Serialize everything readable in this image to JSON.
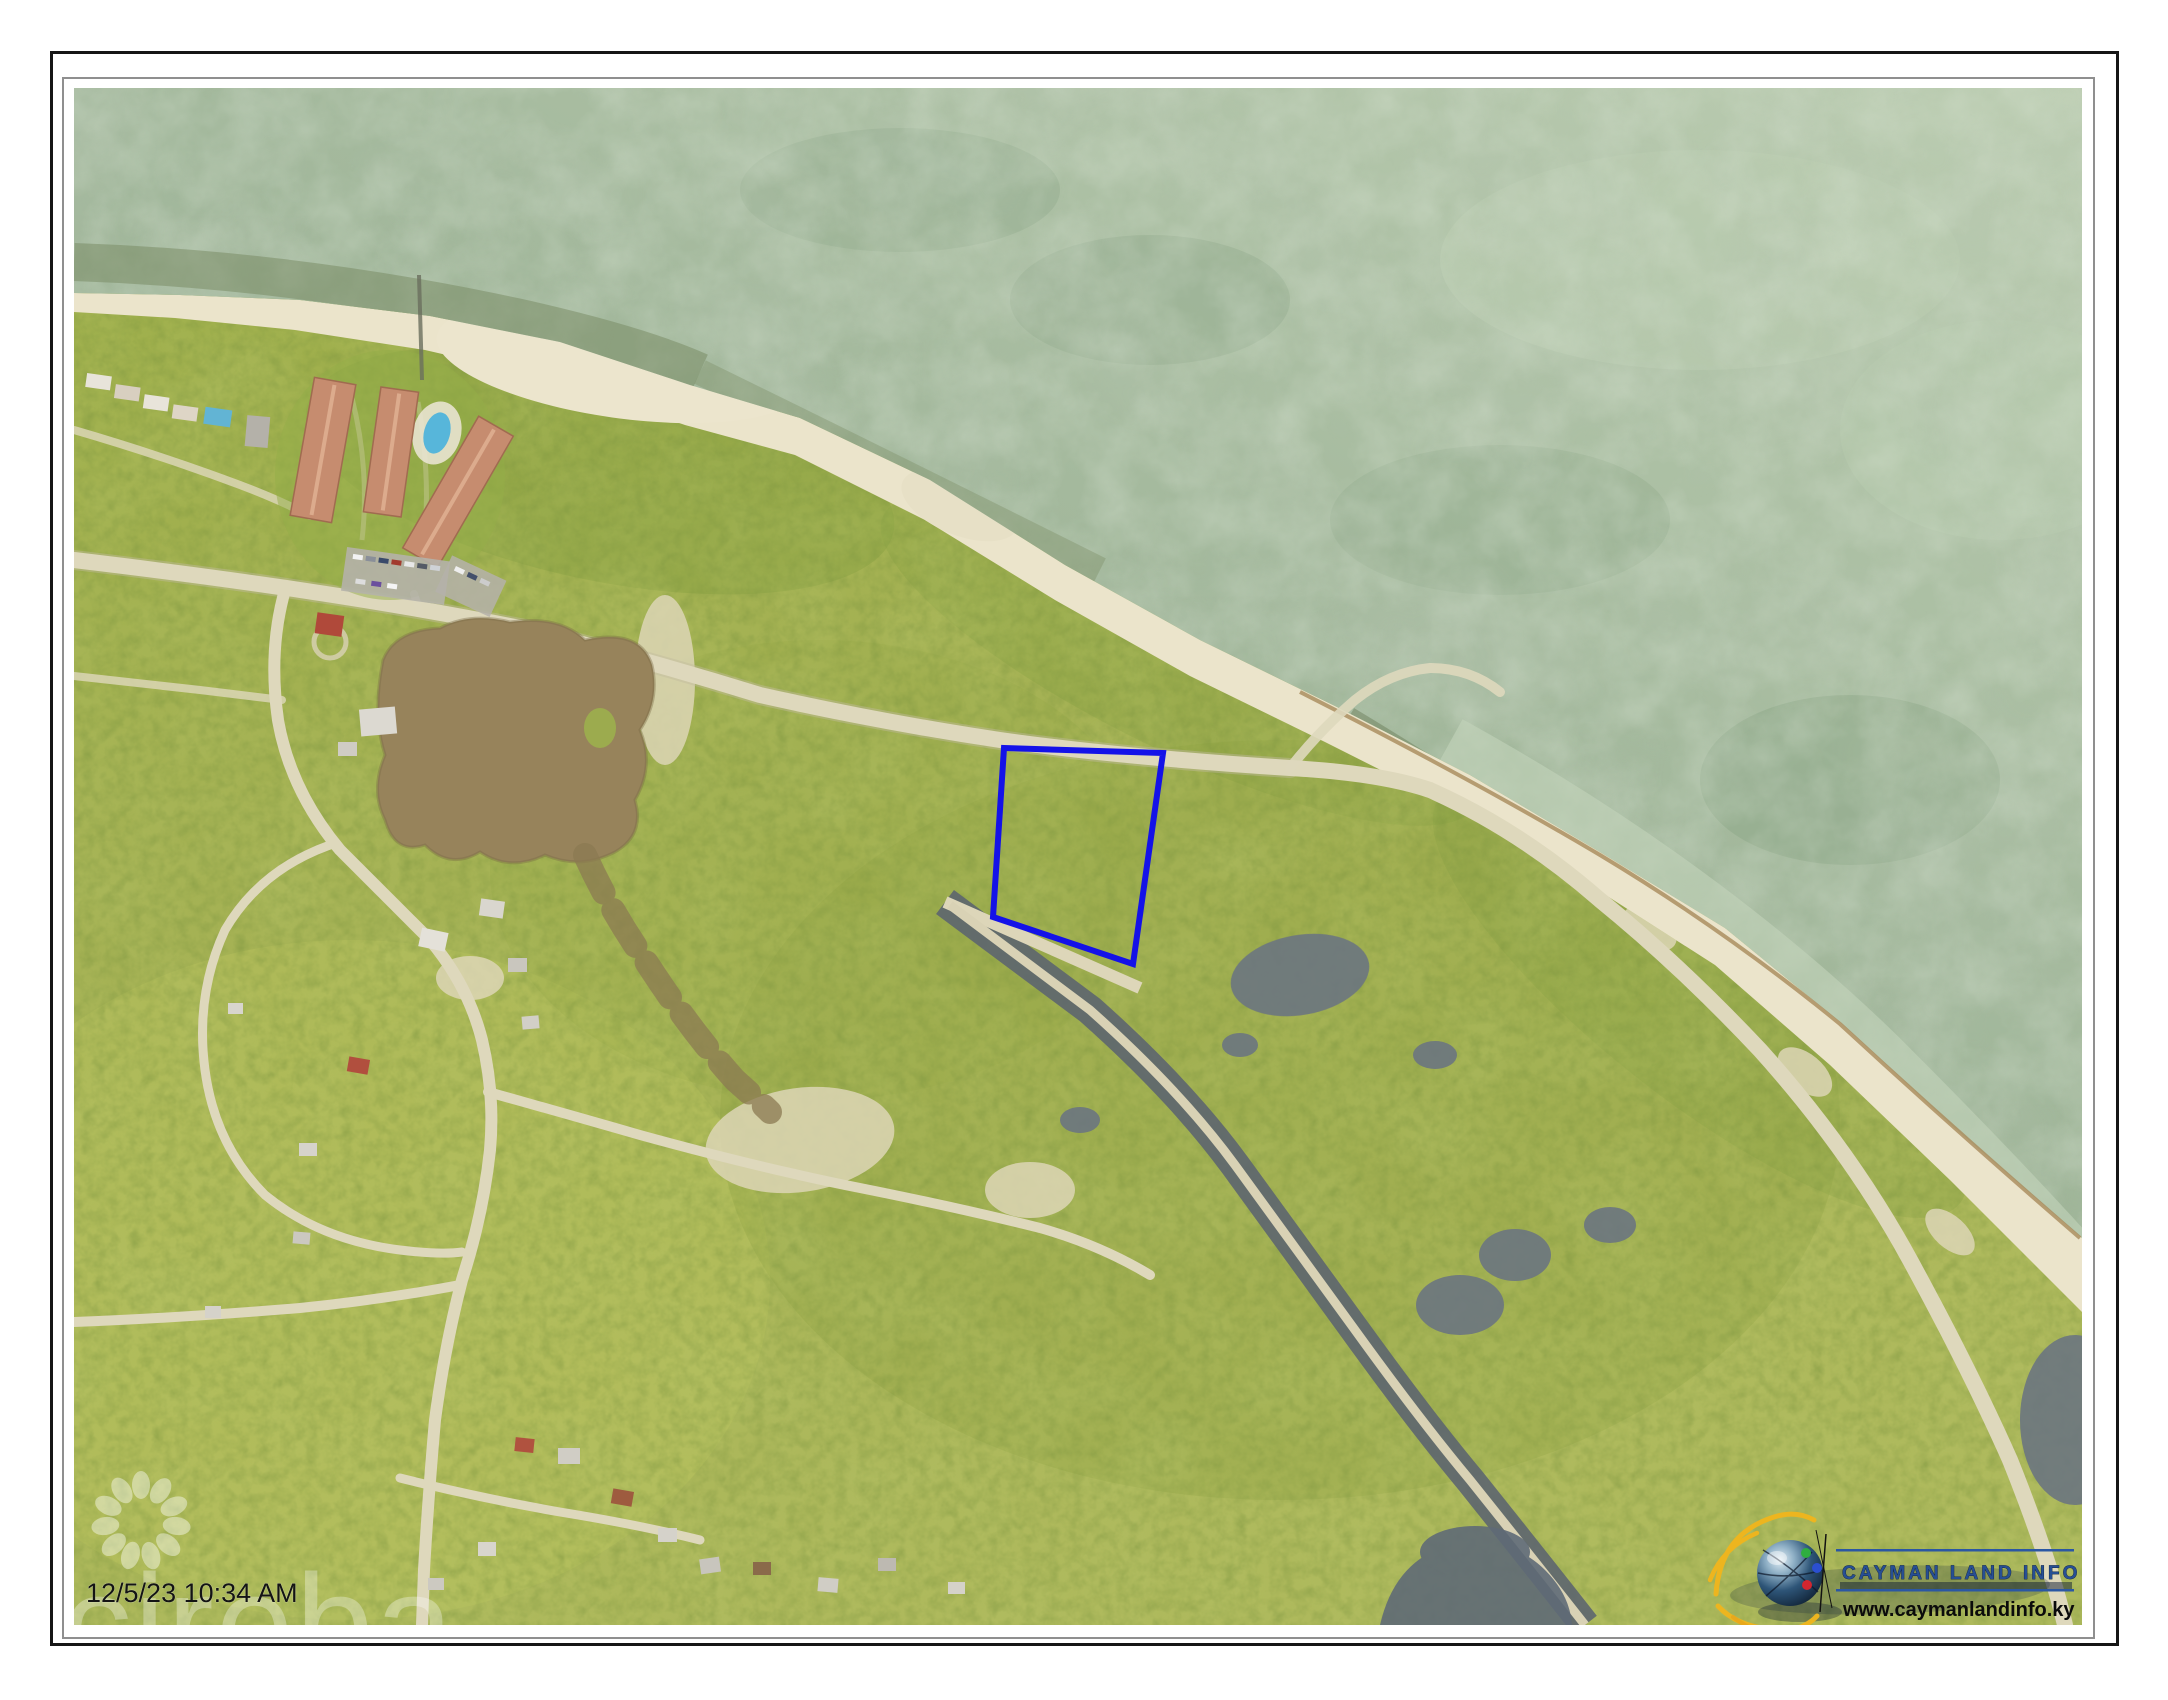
{
  "photo": {
    "timestamp": "12/5/23 10:34 AM",
    "watermark": {
      "text": "cireba"
    },
    "branding": {
      "title": "CAYMAN LAND INFO",
      "website": "www.caymanlandinfo.ky"
    },
    "parcel": {
      "points": "1004,748 1163,753 1133,964 993,917",
      "outline_color": "#1412e8"
    },
    "palette": {
      "ocean_base": "#9cb295",
      "ocean_light": "#bccdb2",
      "ocean_deep_band": "#75875f",
      "sand": "#ebe4cb",
      "vegetation": "#a5b254",
      "road": "#ded8bc",
      "pond_brown": "#97835b",
      "pond_slate": "#6b7580",
      "canal": "#5b6370",
      "condo_roof": "#c68c6f",
      "frame_outer": "#161616",
      "frame_inner": "#8f8f8f"
    }
  }
}
